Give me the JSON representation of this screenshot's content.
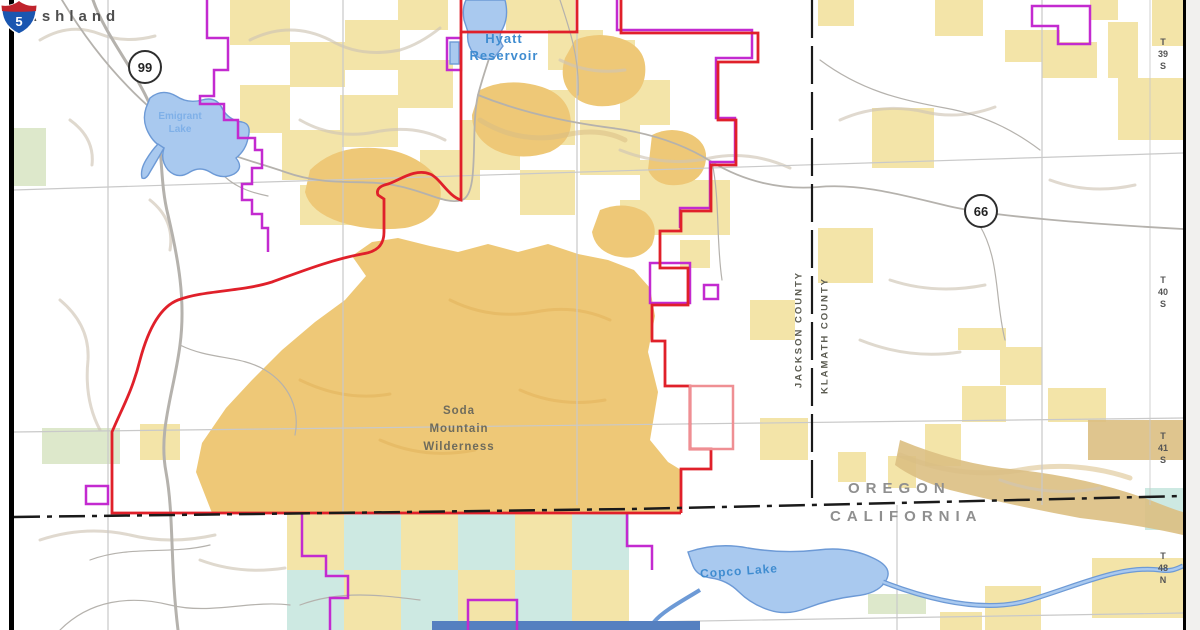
{
  "labels": {
    "city": "Ashland",
    "routes": {
      "r99": "99",
      "r66": "66",
      "i5": "5"
    },
    "water": {
      "hyatt1": "Hyatt",
      "hyatt2": "Reservoir",
      "emigrant1": "Emigrant",
      "emigrant2": "Lake",
      "copco": "Copco Lake"
    },
    "wilderness": {
      "l1": "Soda",
      "l2": "Mountain",
      "l3": "Wilderness"
    },
    "counties": {
      "west": "JACKSON COUNTY",
      "east": "KLAMATH COUNTY"
    },
    "states": {
      "north": "OREGON",
      "south": "CALIFORNIA"
    },
    "townships": [
      {
        "l1": "T",
        "l2": "39",
        "l3": "S"
      },
      {
        "l1": "T",
        "l2": "40",
        "l3": "S"
      },
      {
        "l1": "T",
        "l2": "41",
        "l3": "S"
      },
      {
        "l1": "T",
        "l2": "48",
        "l3": "N"
      }
    ]
  },
  "colors": {
    "map-bg": "#ffffff",
    "blm-yellow": "#f3e4a8",
    "wilderness-tan": "#eec877",
    "ridge-tan": "#dcbf82",
    "teal-land": "#cde9e2",
    "green-land": "#dde8cb",
    "water-fill": "#a9c9ef",
    "water-stroke": "#6d9ad6",
    "river-dark": "#5580c0",
    "monument-purple": "#c32ad0",
    "wilderness-red": "#e0202a",
    "salmon-red": "#ef8f93",
    "road-gray": "#b5b2ad",
    "grid-gray": "#c9c9c9",
    "hillshade": "#cfc5b5",
    "hillshade-dark": "#d9bd85",
    "boundary-black": "#1a1a1a",
    "label-gray": "#4e4e4e",
    "state-label-gray": "#8f8f8f",
    "water-label-blue": "#3f8cd0",
    "wilderness-label": "#6e6b5c",
    "margin-gray": "#f1f0ee",
    "interstate-blue": "#1a56b0",
    "interstate-red": "#c0232c"
  }
}
